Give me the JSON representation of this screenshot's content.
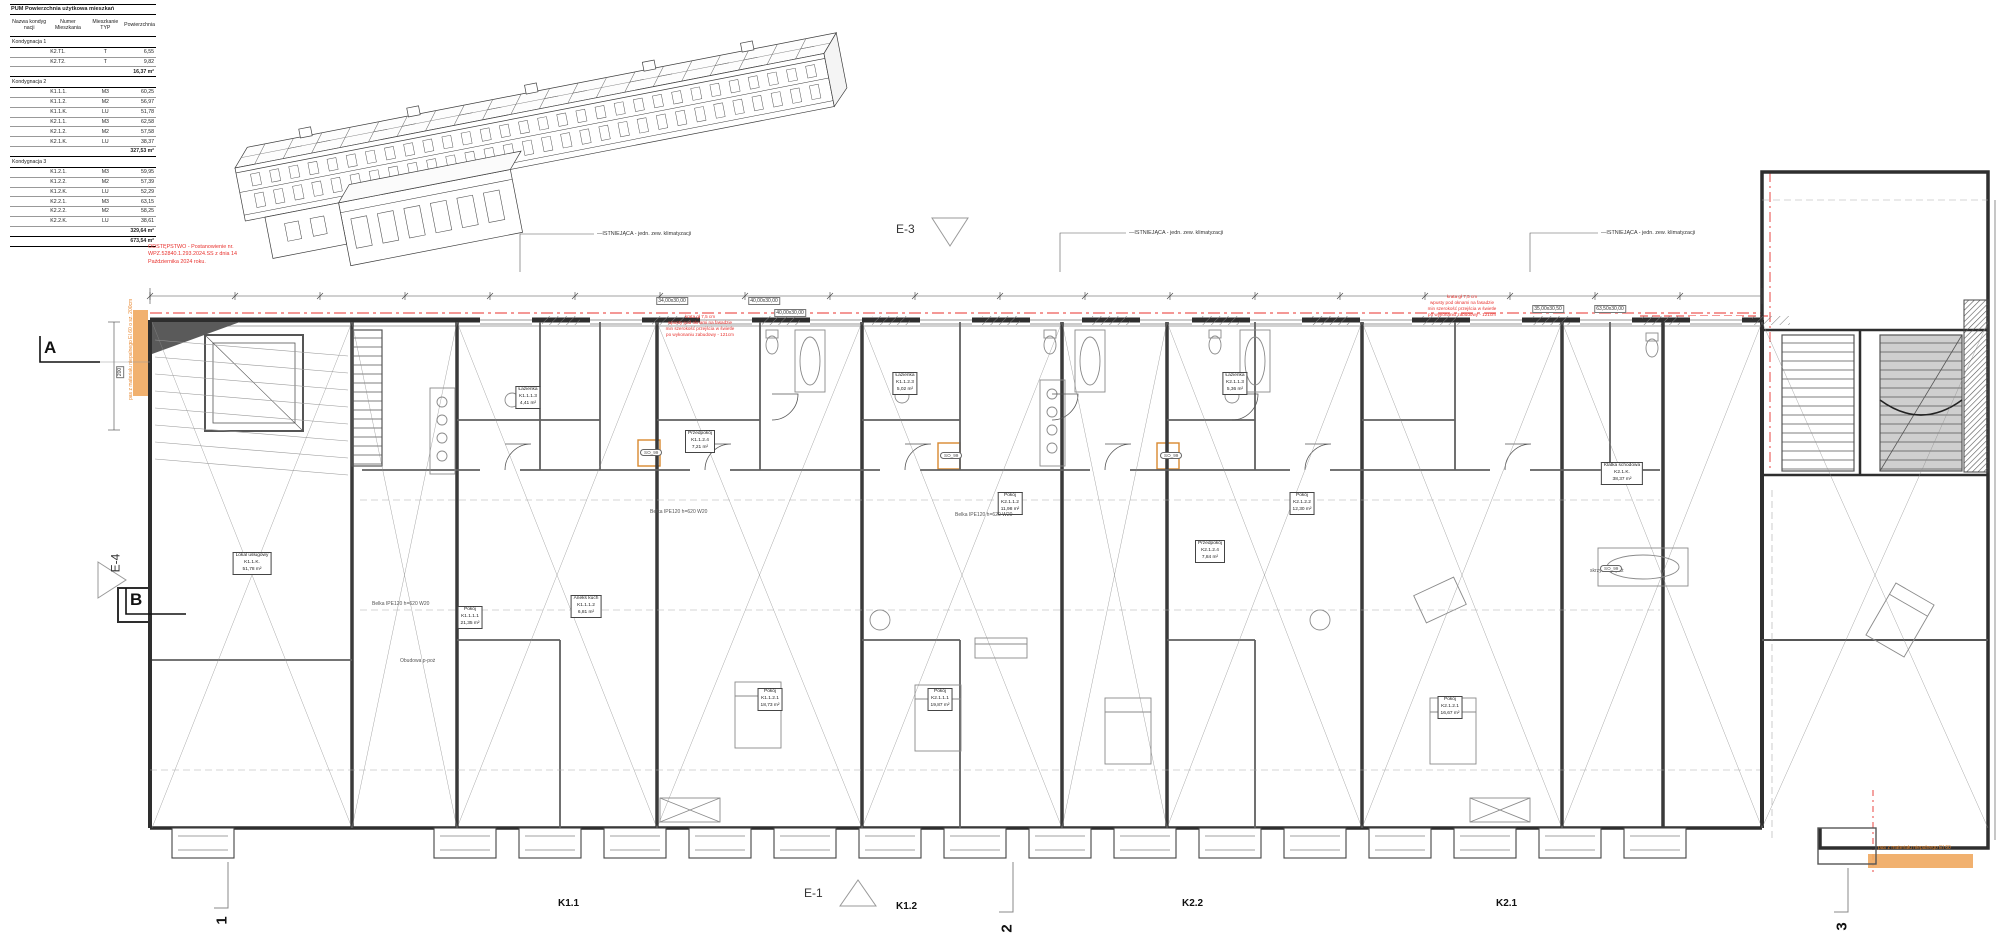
{
  "table": {
    "title": "PUM Powierzchnia użytkowa mieszkań",
    "headers": [
      "Nazwa kondyg nacji",
      "Numer Mieszkania",
      "Mieszkanie TYP",
      "Powierzchnia"
    ],
    "groups": [
      {
        "name": "Kondygnacja 1",
        "rows": [
          [
            "K2.T1.",
            "T",
            "6,55"
          ],
          [
            "K2.T2.",
            "T",
            "9,82"
          ]
        ],
        "subtotal": "16,37 m²"
      },
      {
        "name": "Kondygnacja 2",
        "rows": [
          [
            "K1.1.1.",
            "M3",
            "60,25"
          ],
          [
            "K1.1.2.",
            "M2",
            "56,97"
          ],
          [
            "K1.1.K.",
            "LU",
            "51,78"
          ],
          [
            "K2.1.1.",
            "M3",
            "62,58"
          ],
          [
            "K2.1.2.",
            "M2",
            "57,58"
          ],
          [
            "K2.1.K.",
            "LU",
            "38,37"
          ]
        ],
        "subtotal": "327,53 m²"
      },
      {
        "name": "Kondygnacja 3",
        "rows": [
          [
            "K1.2.1.",
            "M3",
            "59,95"
          ],
          [
            "K1.2.2.",
            "M2",
            "57,39"
          ],
          [
            "K1.2.K.",
            "LU",
            "52,29"
          ],
          [
            "K2.2.1.",
            "M3",
            "63,15"
          ],
          [
            "K2.2.2.",
            "M2",
            "58,25"
          ],
          [
            "K2.2.K.",
            "LU",
            "38,61"
          ]
        ],
        "subtotal": "329,64 m²"
      }
    ],
    "total": "673,54 m²"
  },
  "annotations": {
    "odstepstwo": [
      "ODSTĘPSTWO - Postanowienie nr.",
      "WPZ.52840.1.293.2024.SS z dnia 14",
      "Października 2024 roku."
    ],
    "istniejaca": [
      {
        "text": "ISTNIEJĄCA - jedn. zew. klimatyzacji",
        "x": 597,
        "y": 231
      },
      {
        "text": "ISTNIEJĄCA - jedn. zew. klimatyzacji",
        "x": 1129,
        "y": 230
      },
      {
        "text": "ISTNIEJĄCA - jedn. zew. klimatyzacji",
        "x": 1601,
        "y": 230
      }
    ],
    "pas_left": "pas z materiału niepalnego EI 60 o sz. 200cm",
    "pas_right": "pas z materiału niepalnego EI 60",
    "red_notes": [
      {
        "x": 700,
        "y": 314,
        "lines": [
          "krata gł 7,5 cm",
          "wpusty pod oknami na fasadzie",
          "min szerokość przejścia w świetle",
          "po wykonaniu zabudowy - 121cm"
        ]
      },
      {
        "x": 1462,
        "y": 294,
        "lines": [
          "krata gł 7,5 cm",
          "wpusty pod oknami na fasadzie",
          "min szerokość przejścia w świetle",
          "po wykonaniu zabudowy - 121cm"
        ]
      }
    ],
    "dim_labels": [
      {
        "text": "34,00x30,00",
        "x": 672,
        "y": 297
      },
      {
        "text": "40,00x30,00",
        "x": 764,
        "y": 297
      },
      {
        "text": "40,00x30,00",
        "x": 790,
        "y": 309
      },
      {
        "text": "35,00x30,50",
        "x": 1548,
        "y": 305
      },
      {
        "text": "63,50x30,00",
        "x": 1610,
        "y": 305
      }
    ],
    "left_dim": "200"
  },
  "markers": {
    "section_a": "A",
    "section_b": "B",
    "elev_e1": "E-1",
    "elev_e3": "E-3",
    "elev_e4": "E-4",
    "grid_1": "1",
    "grid_2": "2",
    "grid_3": "3"
  },
  "unit_labels": [
    {
      "text": "K1.1",
      "x": 558,
      "y": 898
    },
    {
      "text": "K1.2",
      "x": 896,
      "y": 901
    },
    {
      "text": "K2.2",
      "x": 1182,
      "y": 898
    },
    {
      "text": "K2.1",
      "x": 1496,
      "y": 898
    }
  ],
  "room_labels": [
    {
      "name": "Lokal usługowy",
      "id": "K1.1.K.",
      "area": "51,78 m²",
      "x": 252,
      "y": 552
    },
    {
      "name": "Pokój",
      "id": "K1.1.1.1",
      "area": "21,35 m²",
      "x": 470,
      "y": 606
    },
    {
      "name": "Aneks kuch",
      "id": "K1.1.1.2",
      "area": "6,81 m²",
      "x": 586,
      "y": 595
    },
    {
      "name": "Łazienka",
      "id": "K1.1.1.3",
      "area": "4,41 m²",
      "x": 528,
      "y": 386
    },
    {
      "name": "Przedpokój",
      "id": "K1.1.2.4",
      "area": "7,21 m²",
      "x": 700,
      "y": 430
    },
    {
      "name": "Pokój",
      "id": "K1.1.2.1",
      "area": "18,73 m²",
      "x": 770,
      "y": 688
    },
    {
      "name": "Łazienka",
      "id": "K1.1.2.3",
      "area": "5,02 m²",
      "x": 905,
      "y": 372
    },
    {
      "name": "Pokój",
      "id": "K2.1.1.2",
      "area": "11,98 m²",
      "x": 1010,
      "y": 492
    },
    {
      "name": "Pokój",
      "id": "K2.1.1.1",
      "area": "19,87 m²",
      "x": 940,
      "y": 688
    },
    {
      "name": "Łazienka",
      "id": "K2.1.1.3",
      "area": "5,36 m²",
      "x": 1235,
      "y": 372
    },
    {
      "name": "Przedpokój",
      "id": "K2.1.2.4",
      "area": "7,84 m²",
      "x": 1210,
      "y": 540
    },
    {
      "name": "Pokój",
      "id": "K2.1.2.2",
      "area": "12,30 m²",
      "x": 1302,
      "y": 492
    },
    {
      "name": "Pokój",
      "id": "K2.1.2.1",
      "area": "16,67 m²",
      "x": 1450,
      "y": 696
    },
    {
      "name": "Klatka schodowa",
      "id": "K2.1.K.",
      "area": "38,37 m²",
      "x": 1622,
      "y": 462
    }
  ],
  "tech_labels": [
    {
      "text": "Obudowa p-poż",
      "x": 400,
      "y": 658
    },
    {
      "text": "skrzynka p-poż",
      "x": 1590,
      "y": 568
    },
    {
      "text": "Belka IPE120 h=620 W20",
      "x": 650,
      "y": 509
    },
    {
      "text": "Belka IPE120 h=620 W20",
      "x": 955,
      "y": 512
    },
    {
      "text": "Belka IPE120 h=620 W20",
      "x": 372,
      "y": 601
    }
  ],
  "so_tags": [
    {
      "text": "SO_99",
      "x": 640,
      "y": 449
    },
    {
      "text": "SO_99",
      "x": 940,
      "y": 452
    },
    {
      "text": "SO_99",
      "x": 1160,
      "y": 452
    },
    {
      "text": "SO_99",
      "x": 1600,
      "y": 565
    }
  ],
  "colors": {
    "red": "#e8322e",
    "orange_fill": "#f0a95f",
    "orange_text": "#e8872e",
    "line_dark": "#2e2e2e",
    "line_mid": "#666666",
    "line_light": "#9a9a9a"
  }
}
